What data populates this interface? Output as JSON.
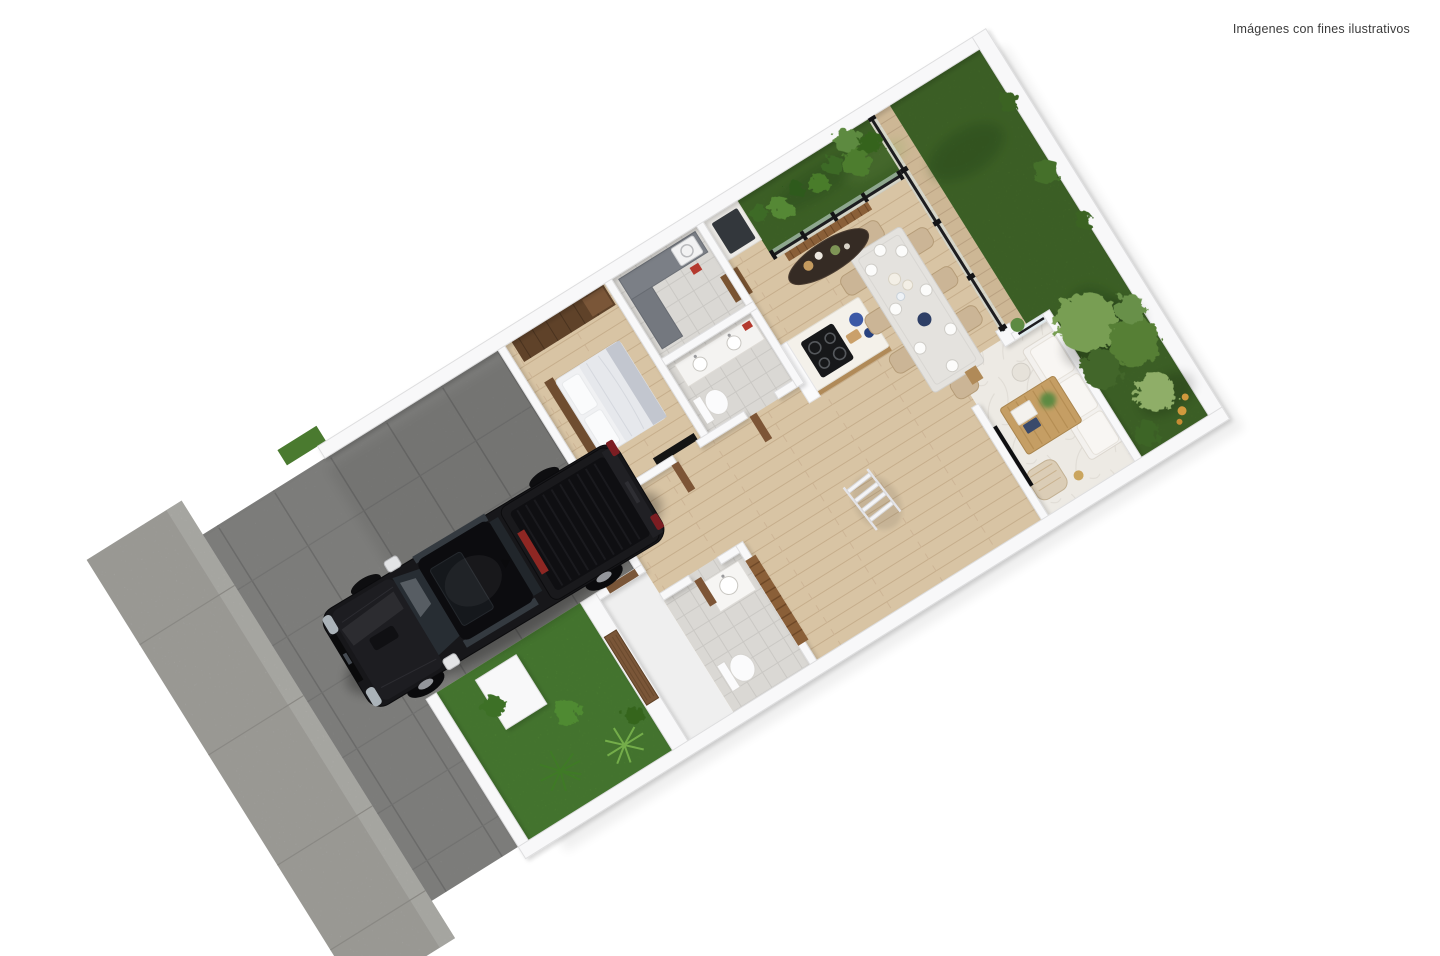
{
  "page": {
    "background": "#ffffff",
    "disclaimer": {
      "text": "Imágenes con fines ilustrativos",
      "color": "#3b3b3b"
    }
  },
  "scene": {
    "type": "3d-floor-plan-render",
    "view": "top-down dollhouse view rotated about 32 degrees, long lot from street (lower-left) to back garden (upper-right)",
    "property": "single-storey house: driveway with pickup truck, front yard, bedroom, two bathrooms, laundry, open kitchen-dining, living room, back lawn with trees"
  },
  "palette": {
    "wall": "#f8f8f9",
    "wall_edge": "#dededf",
    "wood_floor": "#d8c4a4",
    "wood_floor_line": "#c6ae8c",
    "marble_floor": "#edeae4",
    "tile_floor": "#dad8d4",
    "driveway_concrete": "#8e8e8c",
    "sidewalk_concrete": "#b3b2ad",
    "lawn_green": "#4d7a30",
    "front_lawn_green": "#55913a",
    "foliage_dark": "#3e6526",
    "foliage_mid": "#567f36",
    "foliage_light": "#8fae68",
    "flower_accent": "#d0993d",
    "wood_dark": "#5f4229",
    "wood_door": "#7a5638",
    "wood_mid": "#b08a58",
    "island_top": "#f4f1ea",
    "cooktop_black": "#17181a",
    "dining_chair_beige": "#cbb596",
    "sofa_white": "#f3f1ee",
    "sideboard_dark": "#352b24",
    "glass_pane": "#d3e4e8",
    "truck_body": "#17171a",
    "truck_glass": "#272d33",
    "truck_red_cargo": "#8e2723",
    "bedding_white": "#f0f1f3"
  },
  "regions": [
    {
      "name": "sidewalk",
      "desc": "light concrete walk at street edge"
    },
    {
      "name": "driveway",
      "desc": "grey concrete slabs, truck parked"
    },
    {
      "name": "front-yard",
      "desc": "bright lawn with tropical plants, white planter pillar, wooden gate"
    },
    {
      "name": "garage-carport",
      "desc": "open slab area inside walls"
    },
    {
      "name": "bedroom",
      "desc": "bed, wood wardrobe, nightstand, TV"
    },
    {
      "name": "laundry",
      "desc": "grey counters, washer, fridge nook"
    },
    {
      "name": "main-bathroom",
      "desc": "double vanity, toilet"
    },
    {
      "name": "guest-bathroom",
      "desc": "sink unit, toilet, wood slat screen"
    },
    {
      "name": "hallway",
      "desc": "wood floor, white ladder shelf"
    },
    {
      "name": "kitchen",
      "desc": "island with black cooktop, blue bowls, white column"
    },
    {
      "name": "dining",
      "desc": "table with 8 beige chairs and place settings, dark oval sideboard on wood-slat panel"
    },
    {
      "name": "living",
      "desc": "marble floor, white sofa, slatted coffee table, armchair, floor lamp, TV wall"
    },
    {
      "name": "terrace-deck",
      "desc": "wood strip behind glass sliding doors"
    },
    {
      "name": "back-garden",
      "desc": "large lawn, hedge strip, tree cluster with orange blossoms"
    }
  ],
  "objects": [
    "pickup-truck",
    "bed",
    "wardrobe",
    "nightstand",
    "tv-panel",
    "washer",
    "fridge",
    "double-vanity",
    "toilet",
    "guest-sink",
    "kitchen-island",
    "cooktop",
    "blue-bowls",
    "dining-table",
    "dining-chairs-x8",
    "oval-sideboard",
    "wood-slat-panel",
    "glass-sliding-doors",
    "sofa",
    "coffee-table",
    "armchair",
    "floor-lamp",
    "side-table",
    "magazine-rack",
    "ladder-shelf",
    "entrance-gate-door",
    "interior-doors",
    "planter-pillar",
    "palm-plants",
    "shrubs",
    "trees",
    "lawn"
  ]
}
